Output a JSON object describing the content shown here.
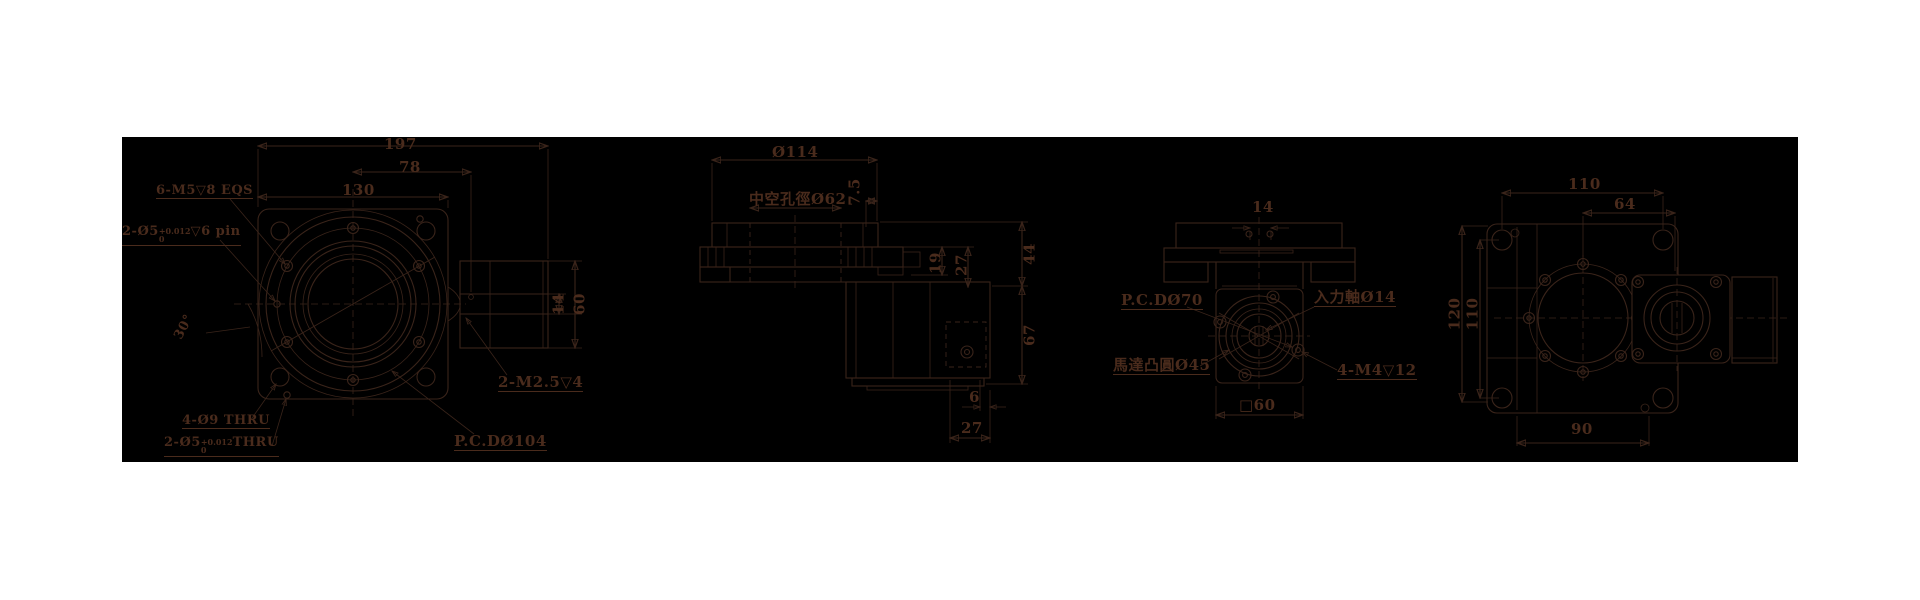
{
  "front_view": {
    "dim_total_width": "197",
    "dim_78": "78",
    "dim_130": "130",
    "dim_angle": "30°",
    "dim_14": "14",
    "dim_60": "60",
    "tap_label": "6-M5▽8 EQS",
    "pin_label_prefix": "2-Ø5",
    "pin_tol_plus": "+0.012",
    "pin_tol_minus": "0",
    "pin_label_suffix": "▽6 pin",
    "thru4_label": "4-Ø9 THRU",
    "thru2_prefix": "2-Ø5",
    "thru2_tol_plus": "+0.012",
    "thru2_tol_minus": "0",
    "thru2_suffix": "THRU",
    "pcd_label": "P.C.DØ104",
    "side_tap_label": "2-M2.5▽4"
  },
  "section_view": {
    "dim_od": "Ø114",
    "bore_label": "中空孔徑Ø62",
    "dim_7_5": "7.5",
    "dim_19": "19",
    "dim_27_side": "27",
    "dim_44": "44",
    "dim_67": "67",
    "dim_6": "6",
    "dim_27_bottom": "27"
  },
  "motor_view": {
    "dim_14": "14",
    "pcd_label": "P.C.DØ70",
    "shaft_label": "入力軸Ø14",
    "boss_label": "馬達凸圓Ø45",
    "tap_label": "4-M4▽12",
    "dim_square": "□60"
  },
  "side_view": {
    "dim_110_top": "110",
    "dim_64": "64",
    "dim_120": "120",
    "dim_110_left": "110",
    "dim_90": "90"
  }
}
